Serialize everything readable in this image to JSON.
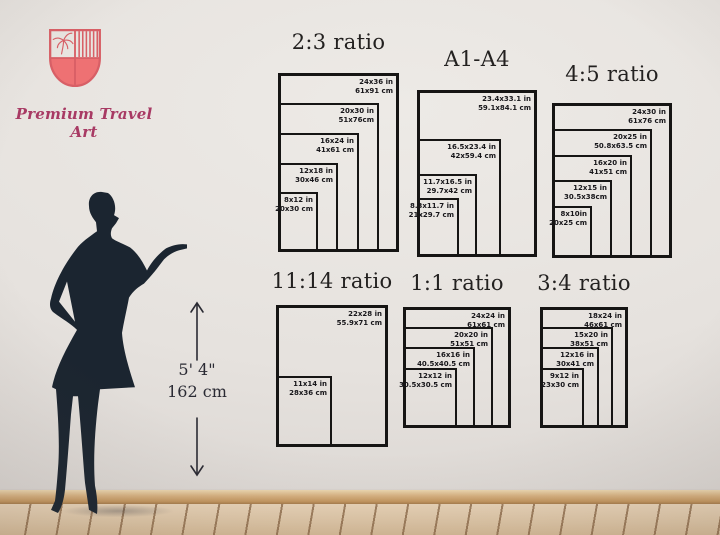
{
  "brand": {
    "name": "Premium Travel Art"
  },
  "logo": {
    "icon": "shield-crest-icon",
    "outline_color": "#d85f66",
    "fill_color": "#ee7173",
    "text_color": "#a83a64"
  },
  "height_marker": {
    "imperial": "5' 4\"",
    "metric": "162 cm"
  },
  "figure": {
    "icon": "woman-silhouette",
    "color": "#1b2530"
  },
  "panels": [
    {
      "id": "2-3",
      "title": "2:3 ratio",
      "sizes": [
        {
          "inches": "24x36 in",
          "cm": "61x91 cm",
          "w_in": 24,
          "h_in": 36
        },
        {
          "inches": "20x30 in",
          "cm": "51x76cm",
          "w_in": 20,
          "h_in": 30
        },
        {
          "inches": "16x24 in",
          "cm": "41x61 cm",
          "w_in": 16,
          "h_in": 24
        },
        {
          "inches": "12x18 in",
          "cm": "30x46 cm",
          "w_in": 12,
          "h_in": 18
        },
        {
          "inches": "8x12 in",
          "cm": "20x30 cm",
          "w_in": 8,
          "h_in": 12
        }
      ]
    },
    {
      "id": "a1-a4",
      "title": "A1-A4",
      "sizes": [
        {
          "inches": "23.4x33.1 in",
          "cm": "59.1x84.1 cm",
          "w_in": 23.4,
          "h_in": 33.1
        },
        {
          "inches": "16.5x23.4 in",
          "cm": "42x59.4 cm",
          "w_in": 16.5,
          "h_in": 23.4
        },
        {
          "inches": "11.7x16.5 in",
          "cm": "29.7x42 cm",
          "w_in": 11.7,
          "h_in": 16.5
        },
        {
          "inches": "8.3x11.7 in",
          "cm": "21x29.7 cm",
          "w_in": 8.3,
          "h_in": 11.7
        }
      ]
    },
    {
      "id": "4-5",
      "title": "4:5 ratio",
      "sizes": [
        {
          "inches": "24x30 in",
          "cm": "61x76 cm",
          "w_in": 24,
          "h_in": 30
        },
        {
          "inches": "20x25 in",
          "cm": "50.8x63.5 cm",
          "w_in": 20,
          "h_in": 25
        },
        {
          "inches": "16x20 in",
          "cm": "41x51 cm",
          "w_in": 16,
          "h_in": 20
        },
        {
          "inches": "12x15 in",
          "cm": "30.5x38cm",
          "w_in": 12,
          "h_in": 15
        },
        {
          "inches": "8x10in",
          "cm": "20x25 cm",
          "w_in": 8,
          "h_in": 10
        }
      ]
    },
    {
      "id": "11-14",
      "title": "11:14 ratio",
      "sizes": [
        {
          "inches": "22x28 in",
          "cm": "55.9x71 cm",
          "w_in": 22,
          "h_in": 28
        },
        {
          "inches": "11x14 in",
          "cm": "28x36 cm",
          "w_in": 11,
          "h_in": 14
        }
      ]
    },
    {
      "id": "1-1",
      "title": "1:1 ratio",
      "sizes": [
        {
          "inches": "24x24 in",
          "cm": "61x61 cm",
          "w_in": 24,
          "h_in": 24
        },
        {
          "inches": "20x20 in",
          "cm": "51x51 cm",
          "w_in": 20,
          "h_in": 20
        },
        {
          "inches": "16x16 in",
          "cm": "40.5x40.5 cm",
          "w_in": 16,
          "h_in": 16
        },
        {
          "inches": "12x12 in",
          "cm": "30.5x30.5 cm",
          "w_in": 12,
          "h_in": 12
        }
      ]
    },
    {
      "id": "3-4",
      "title": "3:4 ratio",
      "sizes": [
        {
          "inches": "18x24 in",
          "cm": "46x61 cm",
          "w_in": 18,
          "h_in": 24
        },
        {
          "inches": "15x20 in",
          "cm": "38x51 cm",
          "w_in": 15,
          "h_in": 20
        },
        {
          "inches": "12x16 in",
          "cm": "30x41 cm",
          "w_in": 12,
          "h_in": 16
        },
        {
          "inches": "9x12 in",
          "cm": "23x30 cm",
          "w_in": 9,
          "h_in": 12
        }
      ]
    }
  ]
}
